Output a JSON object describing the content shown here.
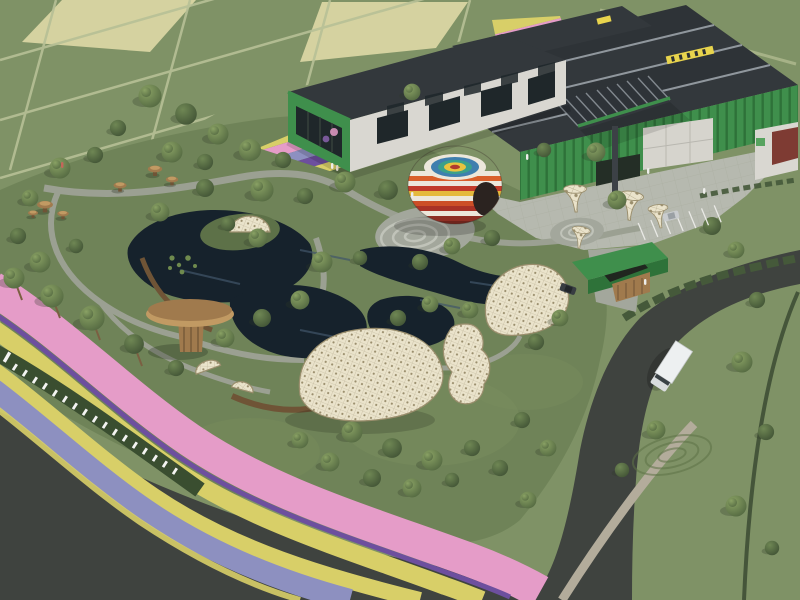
{
  "scene": {
    "type": "aerial-3d-architectural-render",
    "subject": "flower park with greenhouse visitor-center buildings, pond, lattice shell canopies, rainbow dome and curving flower ribbons",
    "sign": {
      "style": "white 3D letters on hedge",
      "legible": false
    },
    "landmarks": [
      "farm-fields",
      "greenhouse-buildings",
      "rainbow-dome",
      "pond",
      "lattice-shell-canopies",
      "mushroom-pavilion",
      "mushroom-stools",
      "trumpet-sculptures",
      "entrance-gate",
      "parking-lot",
      "flower-ribbon",
      "perimeter-road",
      "white-truck"
    ]
  },
  "colors": {
    "grass_field": "#7f9266",
    "grass_park": "#6f8358",
    "grass_dark": "#5d7148",
    "field_pale": "#d5d2a0",
    "field_line": "#b7c096",
    "road": "#3f433f",
    "gravel": "#b3ac9b",
    "ditch": "#37462f",
    "pavement": "#b6b9af",
    "plaza": "#a3a79c",
    "path": "#9ba092",
    "spiral_line": "#c6c9bf",
    "water": "#16222c",
    "water_light": "#41566a",
    "hedge": "#3a4e30",
    "bush": "#45593a",
    "flower_pink": "#e59cc8",
    "flower_purple": "#6d4f9e",
    "flower_yellow": "#d8cf68",
    "flower_blue": "#8d90c0",
    "flower_lilac": "#b48cc8",
    "building_green": "#3f8f4c",
    "building_green_dark": "#2e7239",
    "roof": "#33383c",
    "roof_line": "#90979d",
    "wall_white": "#d9d7d1",
    "window": "#1f272a",
    "door": "#d6d4cd",
    "mural": "#7e3b33",
    "sign_yellow": "#e8d44d",
    "sign_green": "#57a35f",
    "shell": "#eae3cb",
    "shell_line": "#9a8e6d",
    "wood": "#a07a4d",
    "wood_light": "#c19a63",
    "wood_dark": "#6f5436",
    "canopy": "#2e3338",
    "column": "#3c4146",
    "letters": "#f4f4f2",
    "truck": "#edf0f1",
    "car_silver": "#c9ccce",
    "car_dark": "#383d42",
    "tree_light": "#8ba365",
    "tree_mid": "#6f8754",
    "tree_dark": "#526740",
    "tree_deep": "#415335",
    "trunk": "#7b5f42",
    "dome": {
      "rings": [
        "#ece7db",
        "#3f7fae",
        "#3aa08a",
        "#e8c33f",
        "#b03a2e"
      ],
      "body": [
        "#ece7db",
        "#d95f2b",
        "#ece7db",
        "#c13b2a",
        "#e5b93c",
        "#ece7db",
        "#cc4f27",
        "#a93226",
        "#ece7db",
        "#8e2f24",
        "#6e241c"
      ],
      "opening": "#2b2320"
    }
  }
}
